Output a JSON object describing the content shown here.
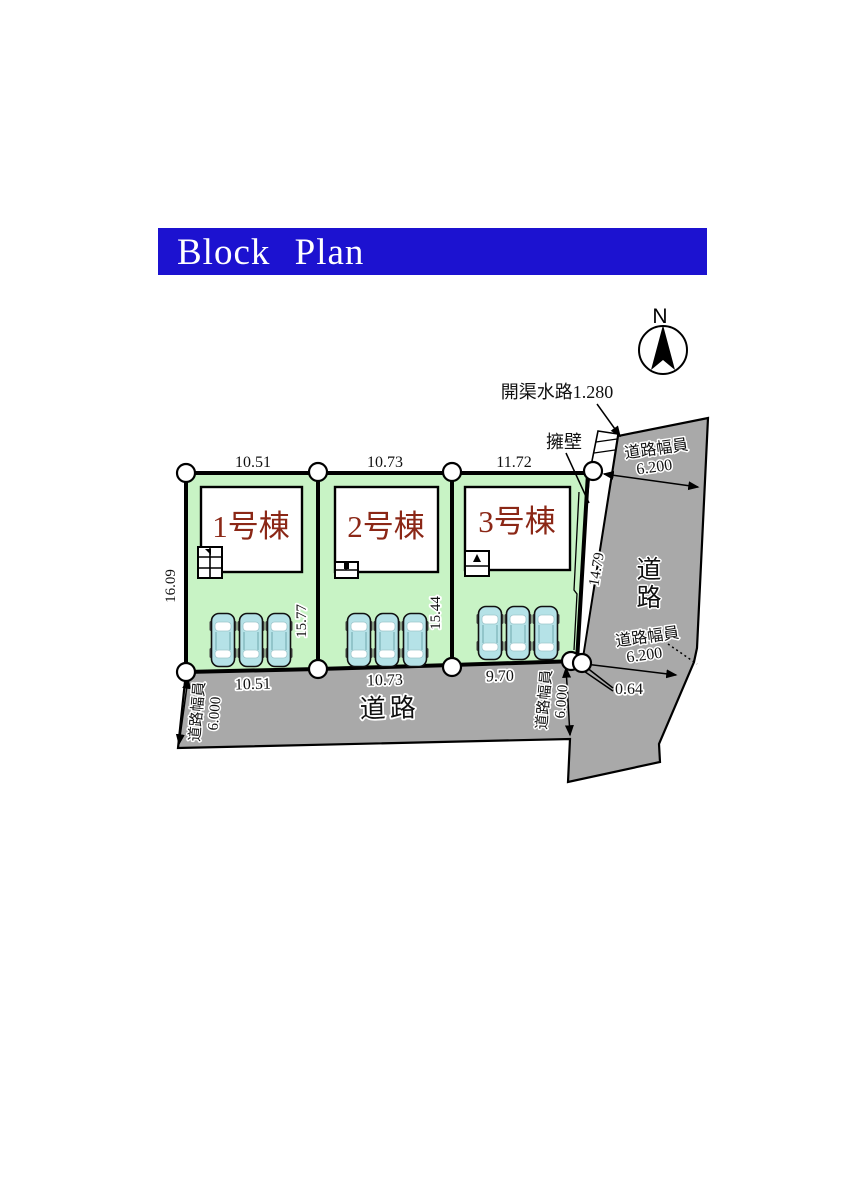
{
  "banner": {
    "title": "Block Plan"
  },
  "compass": {
    "north": "N"
  },
  "annotations": {
    "waterway": "開渠水路1.280",
    "retaining_wall": "擁壁",
    "corner_offset": "0.64"
  },
  "roads": {
    "bottom": {
      "name": "道路",
      "width_caption": "道路幅員",
      "width_value": "6.000"
    },
    "right": {
      "name": "道路",
      "width_caption": "道路幅員",
      "width_value": "6.200"
    }
  },
  "lots": [
    {
      "name": "1号棟",
      "width_top": "10.51",
      "width_bottom": "10.51",
      "depth_left": "16.09",
      "depth_right": "15.77"
    },
    {
      "name": "2号棟",
      "width_top": "10.73",
      "width_bottom": "10.73",
      "depth_right": "15.44"
    },
    {
      "name": "3号棟",
      "width_top": "11.72",
      "width_bottom": "9.70",
      "depth_right": "14.79"
    }
  ],
  "colors": {
    "banner_blue": "#1c12d0",
    "lot_green": "#c8f3c5",
    "road_gray": "#a9a9a9",
    "car_blue": "#b5e2e7",
    "label_red": "#8b2716"
  }
}
